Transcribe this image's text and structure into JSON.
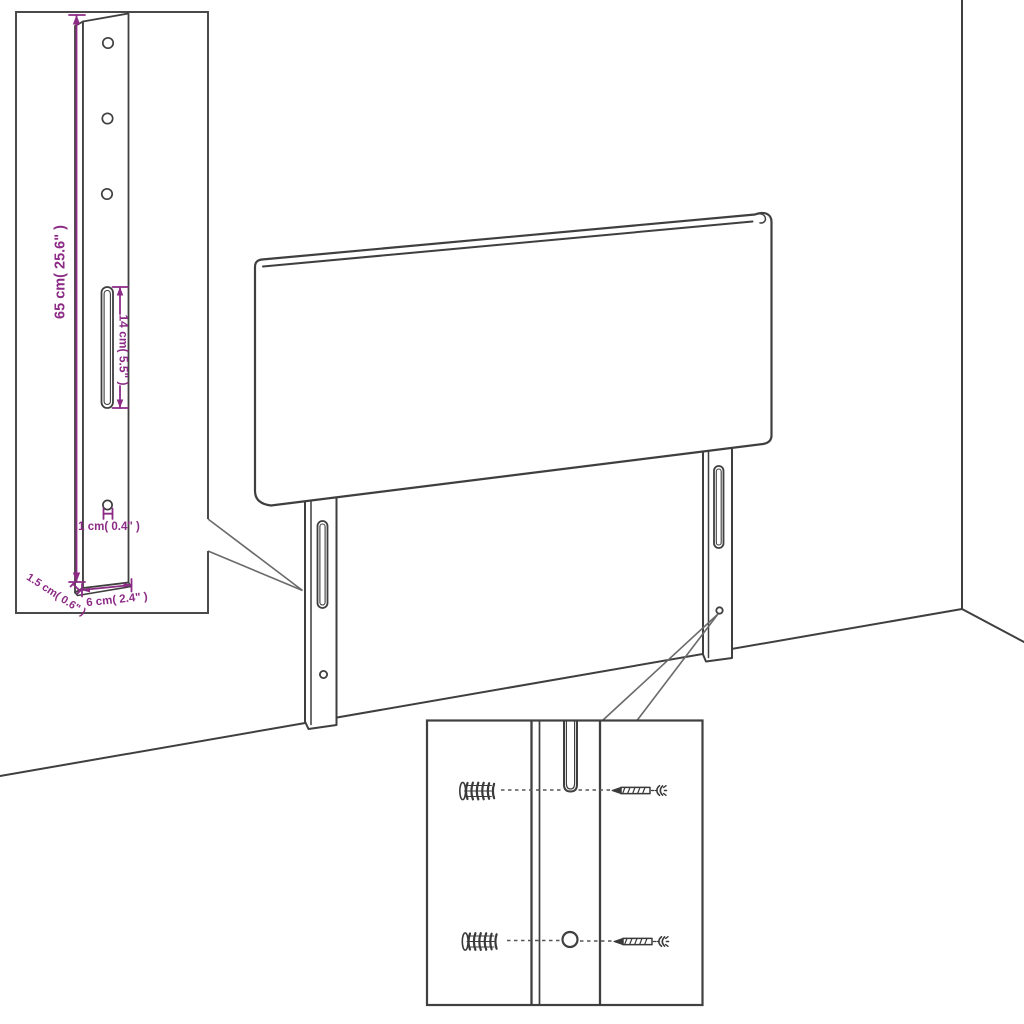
{
  "diagram": {
    "title": "headboard-assembly-diagram",
    "colors": {
      "background": "#ffffff",
      "drawing_line": "#3f3f3f",
      "accent_dimension": "#8C2B85",
      "callout_line": "#6a6a6a"
    },
    "leg_detail": {
      "height_label": "65 cm( 25.6\" )",
      "slot_label": "14 cm( 5.5\" )",
      "hole_label": "1 cm( 0.4\" )",
      "thickness_label": "1.5 cm( 0.6\" )",
      "width_label": "6 cm( 2.4\" )"
    },
    "fastener_detail": {
      "anchor_icon": "wall-anchor-icon",
      "screw_icon": "screw-icon"
    }
  }
}
